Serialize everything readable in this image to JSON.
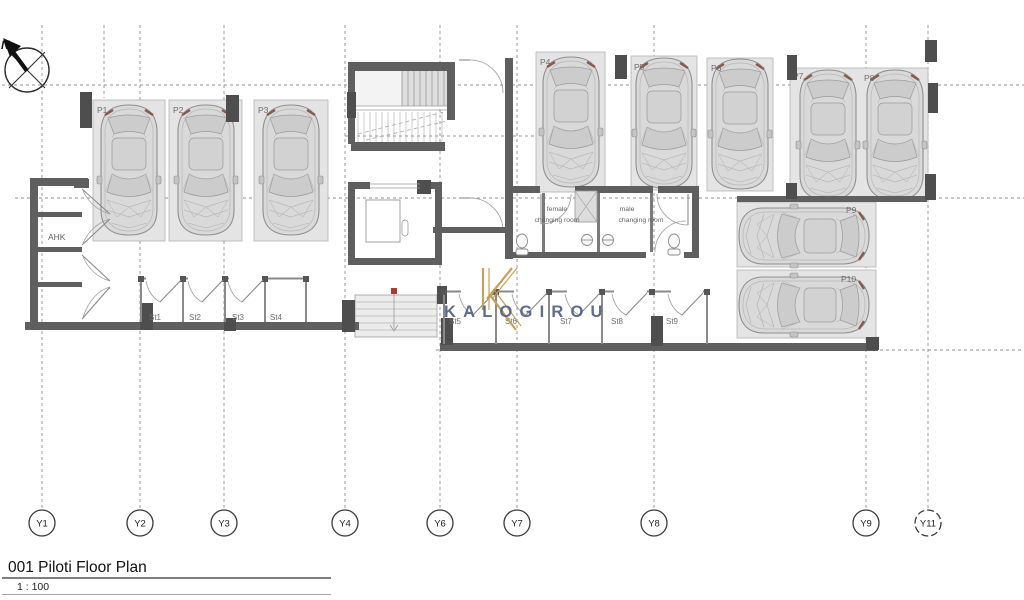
{
  "compass": {
    "label": "N"
  },
  "grid": {
    "labels": [
      "Y1",
      "Y2",
      "Y3",
      "Y4",
      "Y6",
      "Y7",
      "Y8",
      "Y9",
      "Y11"
    ]
  },
  "parking_spaces": {
    "labels": [
      "P1",
      "P2",
      "P3",
      "P4",
      "P5",
      "P6",
      "P7",
      "P8",
      "P9",
      "P10"
    ]
  },
  "storage_rooms": {
    "labels": [
      "St1",
      "St2",
      "St3",
      "St4",
      "St5",
      "St6",
      "St7",
      "St8",
      "St9"
    ]
  },
  "rooms": {
    "ahk": "AHK",
    "female_changing_line1": "female",
    "female_changing_line2": "changing room",
    "male_changing_line1": "male",
    "male_changing_line2": "changing room"
  },
  "watermark": {
    "brand": "KALOGIROU",
    "gold_color": "#c7a15a",
    "navy_color": "#475a80"
  },
  "ramp": {
    "marker_color": "#b03a34"
  },
  "title_block": {
    "title": "001 Piloti Floor Plan",
    "scale": "1 : 100"
  }
}
